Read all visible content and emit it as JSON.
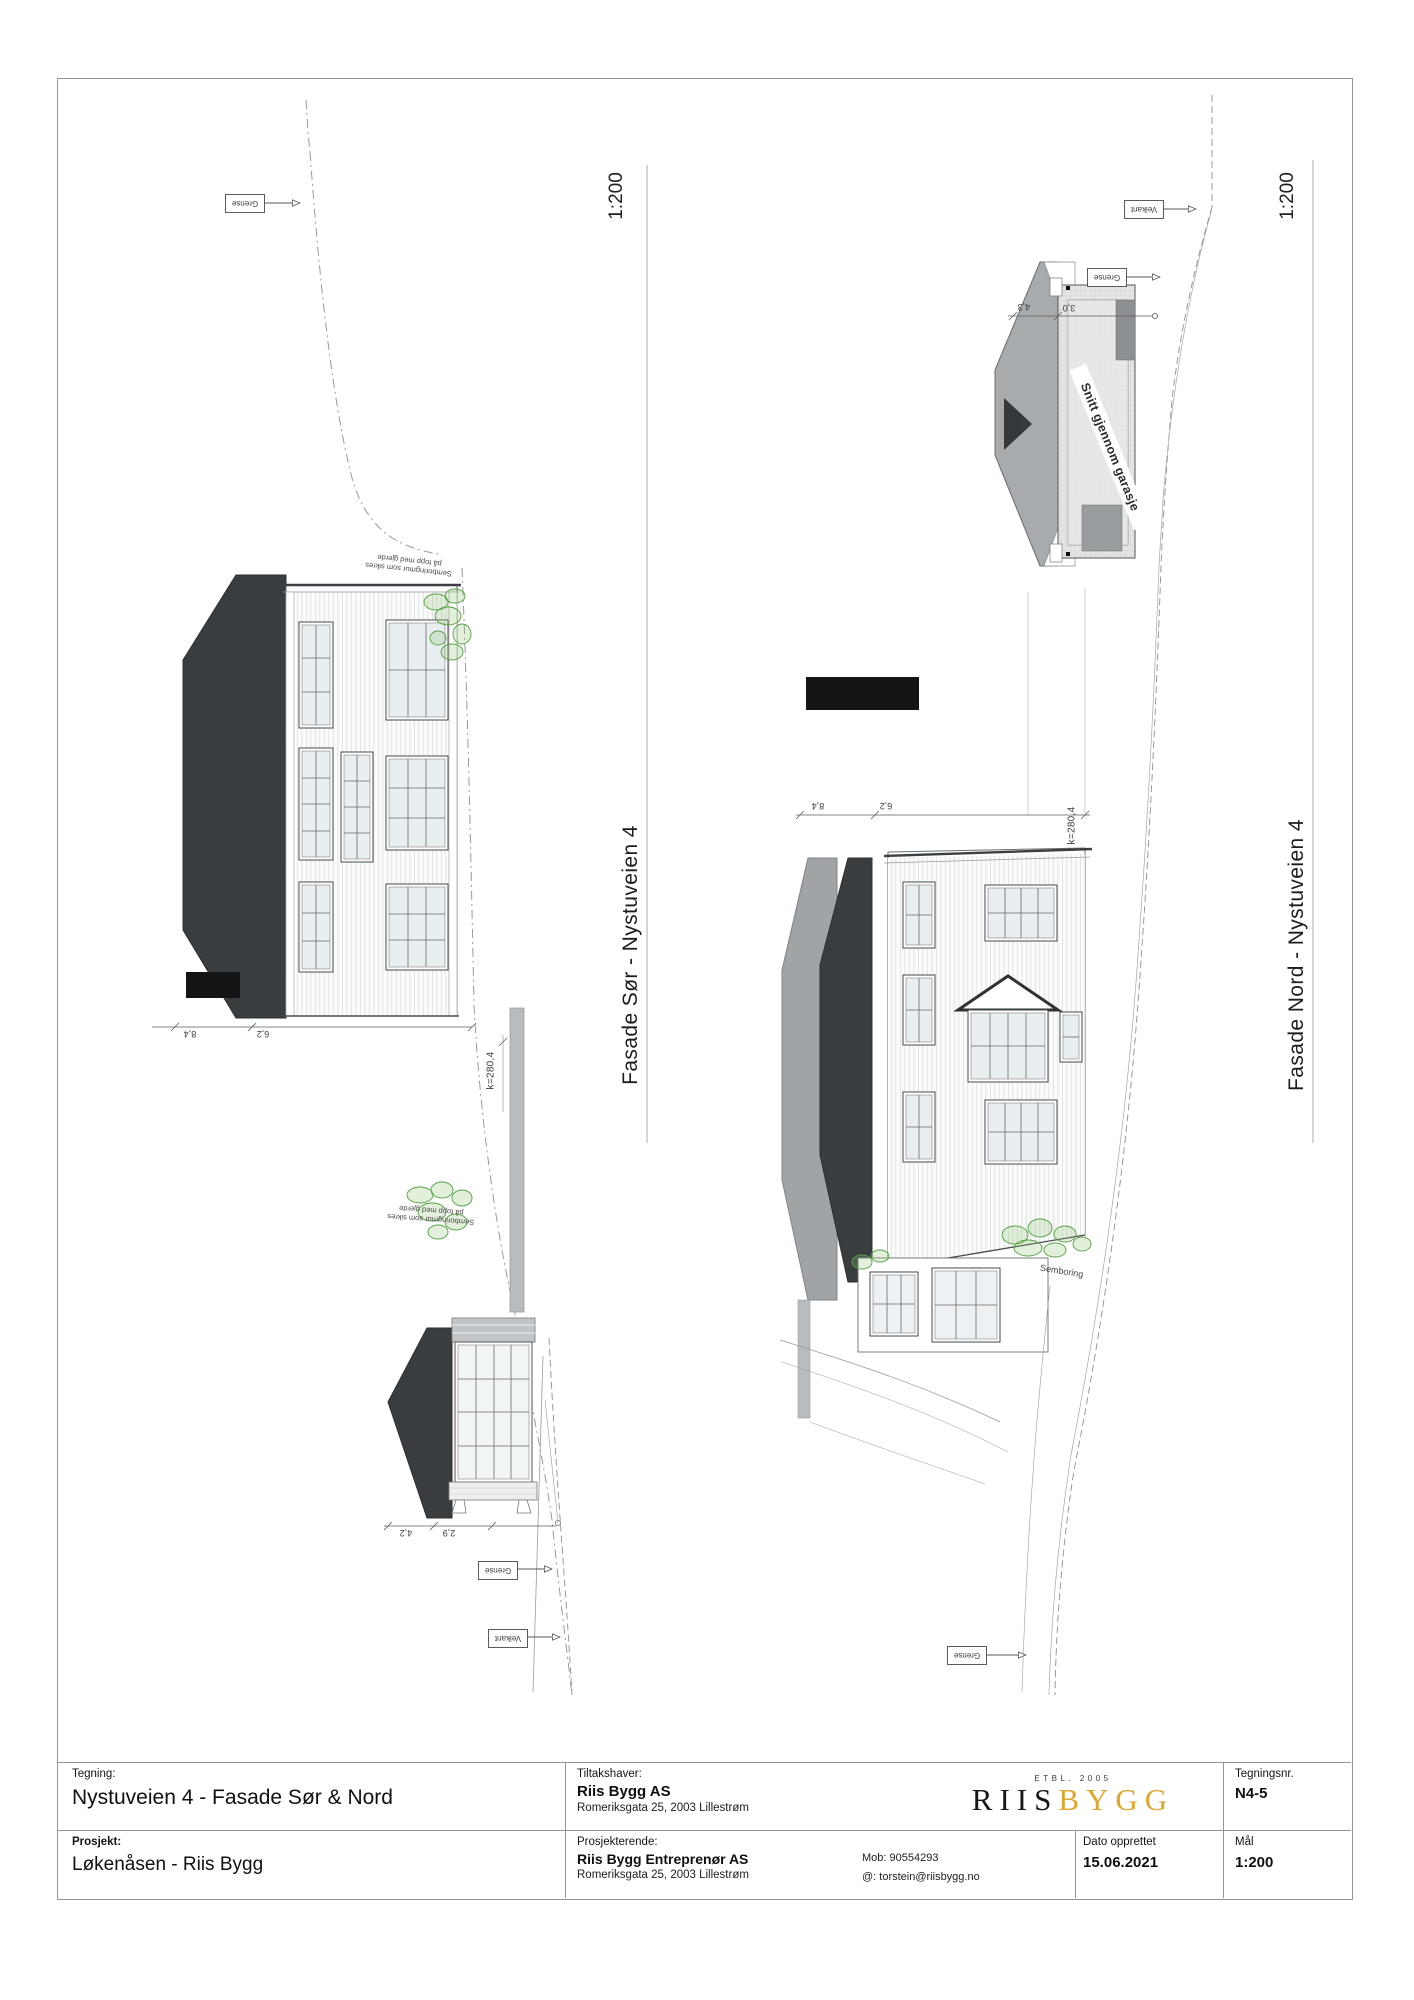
{
  "title_block": {
    "tegning_label": "Tegning:",
    "tegning_value": "Nystuveien 4 - Fasade Sør & Nord",
    "tiltakshaver_label": "Tiltakshaver:",
    "tiltakshaver_name": "Riis Bygg AS",
    "tiltakshaver_address": "Romeriksgata 25, 2003 Lillestrøm",
    "logo": {
      "etbl": "ETBL. 2005",
      "part1": "RIIS",
      "part2": "BYGG",
      "color1": "#181818",
      "color2": "#dfa62d"
    },
    "tegningsnr_label": "Tegningsnr.",
    "tegningsnr_value": "N4-5",
    "prosjekt_label": "Prosjekt:",
    "prosjekt_value": "Løkenåsen - Riis Bygg",
    "prosjekterende_label": "Prosjekterende:",
    "prosjekterende_name": "Riis Bygg Entreprenør AS",
    "prosjekterende_address": "Romeriksgata 25, 2003 Lillestrøm",
    "mob": "Mob: 90554293",
    "email": "@: torstein@riisbygg.no",
    "dato_label": "Dato opprettet",
    "dato_value": "15.06.2021",
    "maal_label": "Mål",
    "maal_value": "1:200"
  },
  "south": {
    "scale": "1:200",
    "axis_label": "Fasade Sør - Nystuveien 4",
    "grense_top": "Grense",
    "grense_bottom": "Grense",
    "veikant": "Veikant",
    "wall_note_line1": "Semboringmur som sikres",
    "wall_note_line2": "på topp med gjerde",
    "dim1": "8,4",
    "dim2": "6,2",
    "garage_dim1": "4,2",
    "garage_dim2": "2,9",
    "level": "k=280,4"
  },
  "north": {
    "scale": "1:200",
    "axis_label": "Fasade Nord - Nystuveien 4",
    "veikant": "Veikant",
    "grense_garage": "Grense",
    "grense_bottom": "Grense",
    "garage_section_label": "Snitt gjennom garasje",
    "semboring": "Semboring",
    "dim1": "8,4",
    "dim2": "6,2",
    "section_dim1": "4,3",
    "section_dim2": "3,0",
    "level": "k=280,4"
  }
}
